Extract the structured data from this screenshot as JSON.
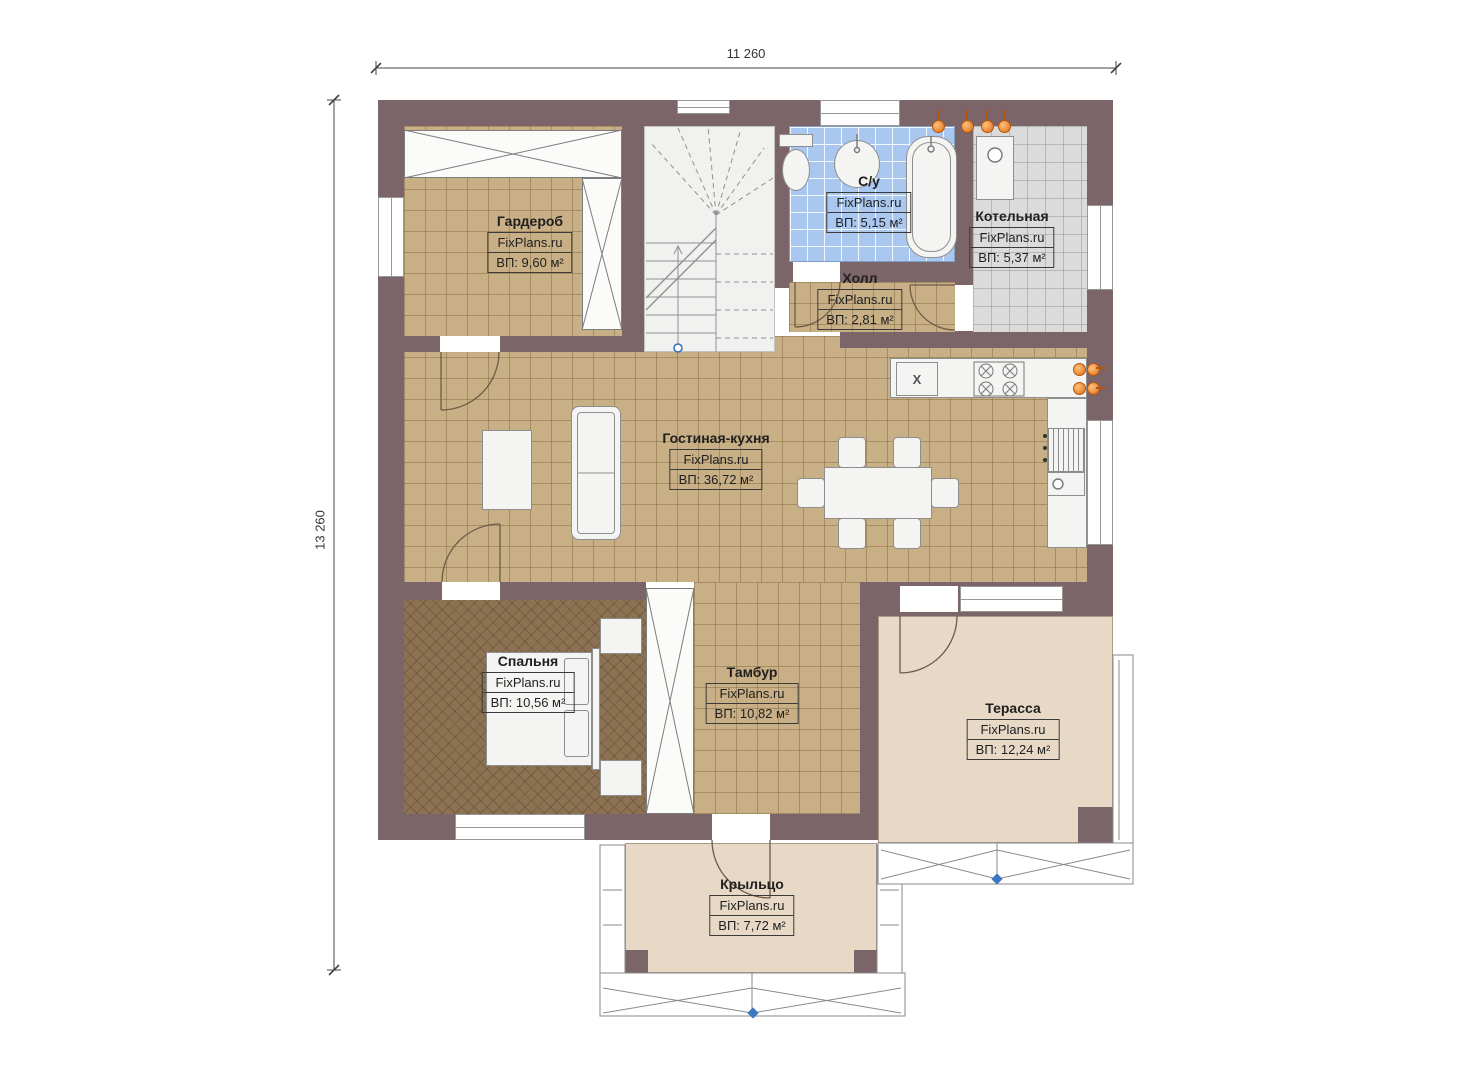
{
  "watermark": "FixPlans.ru",
  "dimensions": {
    "width": "11 260",
    "height": "13 260"
  },
  "rooms": [
    {
      "key": "wardrobe",
      "name": "Гардероб",
      "area": "ВП: 9,60 м²"
    },
    {
      "key": "bathroom",
      "name": "С/у",
      "area": "ВП: 5,15 м²"
    },
    {
      "key": "boiler",
      "name": "Котельная",
      "area": "ВП: 5,37 м²"
    },
    {
      "key": "hall",
      "name": "Холл",
      "area": "ВП: 2,81 м²"
    },
    {
      "key": "living_kitchen",
      "name": "Гостиная-кухня",
      "area": "ВП: 36,72 м²"
    },
    {
      "key": "bedroom",
      "name": "Спальня",
      "area": "ВП: 10,56 м²"
    },
    {
      "key": "tambour",
      "name": "Тамбур",
      "area": "ВП: 10,82 м²"
    },
    {
      "key": "terrace",
      "name": "Терасса",
      "area": "ВП: 12,24 м²"
    },
    {
      "key": "porch",
      "name": "Крыльцо",
      "area": "ВП: 7,72 м²"
    }
  ],
  "kitchen": {
    "sink_symbol": "X"
  },
  "colors": {
    "wall": "#7c6568",
    "floor_tile": "#c9af85",
    "bathroom_tile": "#aac8ef",
    "boiler_tile": "#dbdbdb",
    "bedroom_floor": "#8c7252",
    "outdoor_floor": "#e7d9c6",
    "accent_orange": "#e06a12",
    "marker_blue": "#3c77c2"
  }
}
